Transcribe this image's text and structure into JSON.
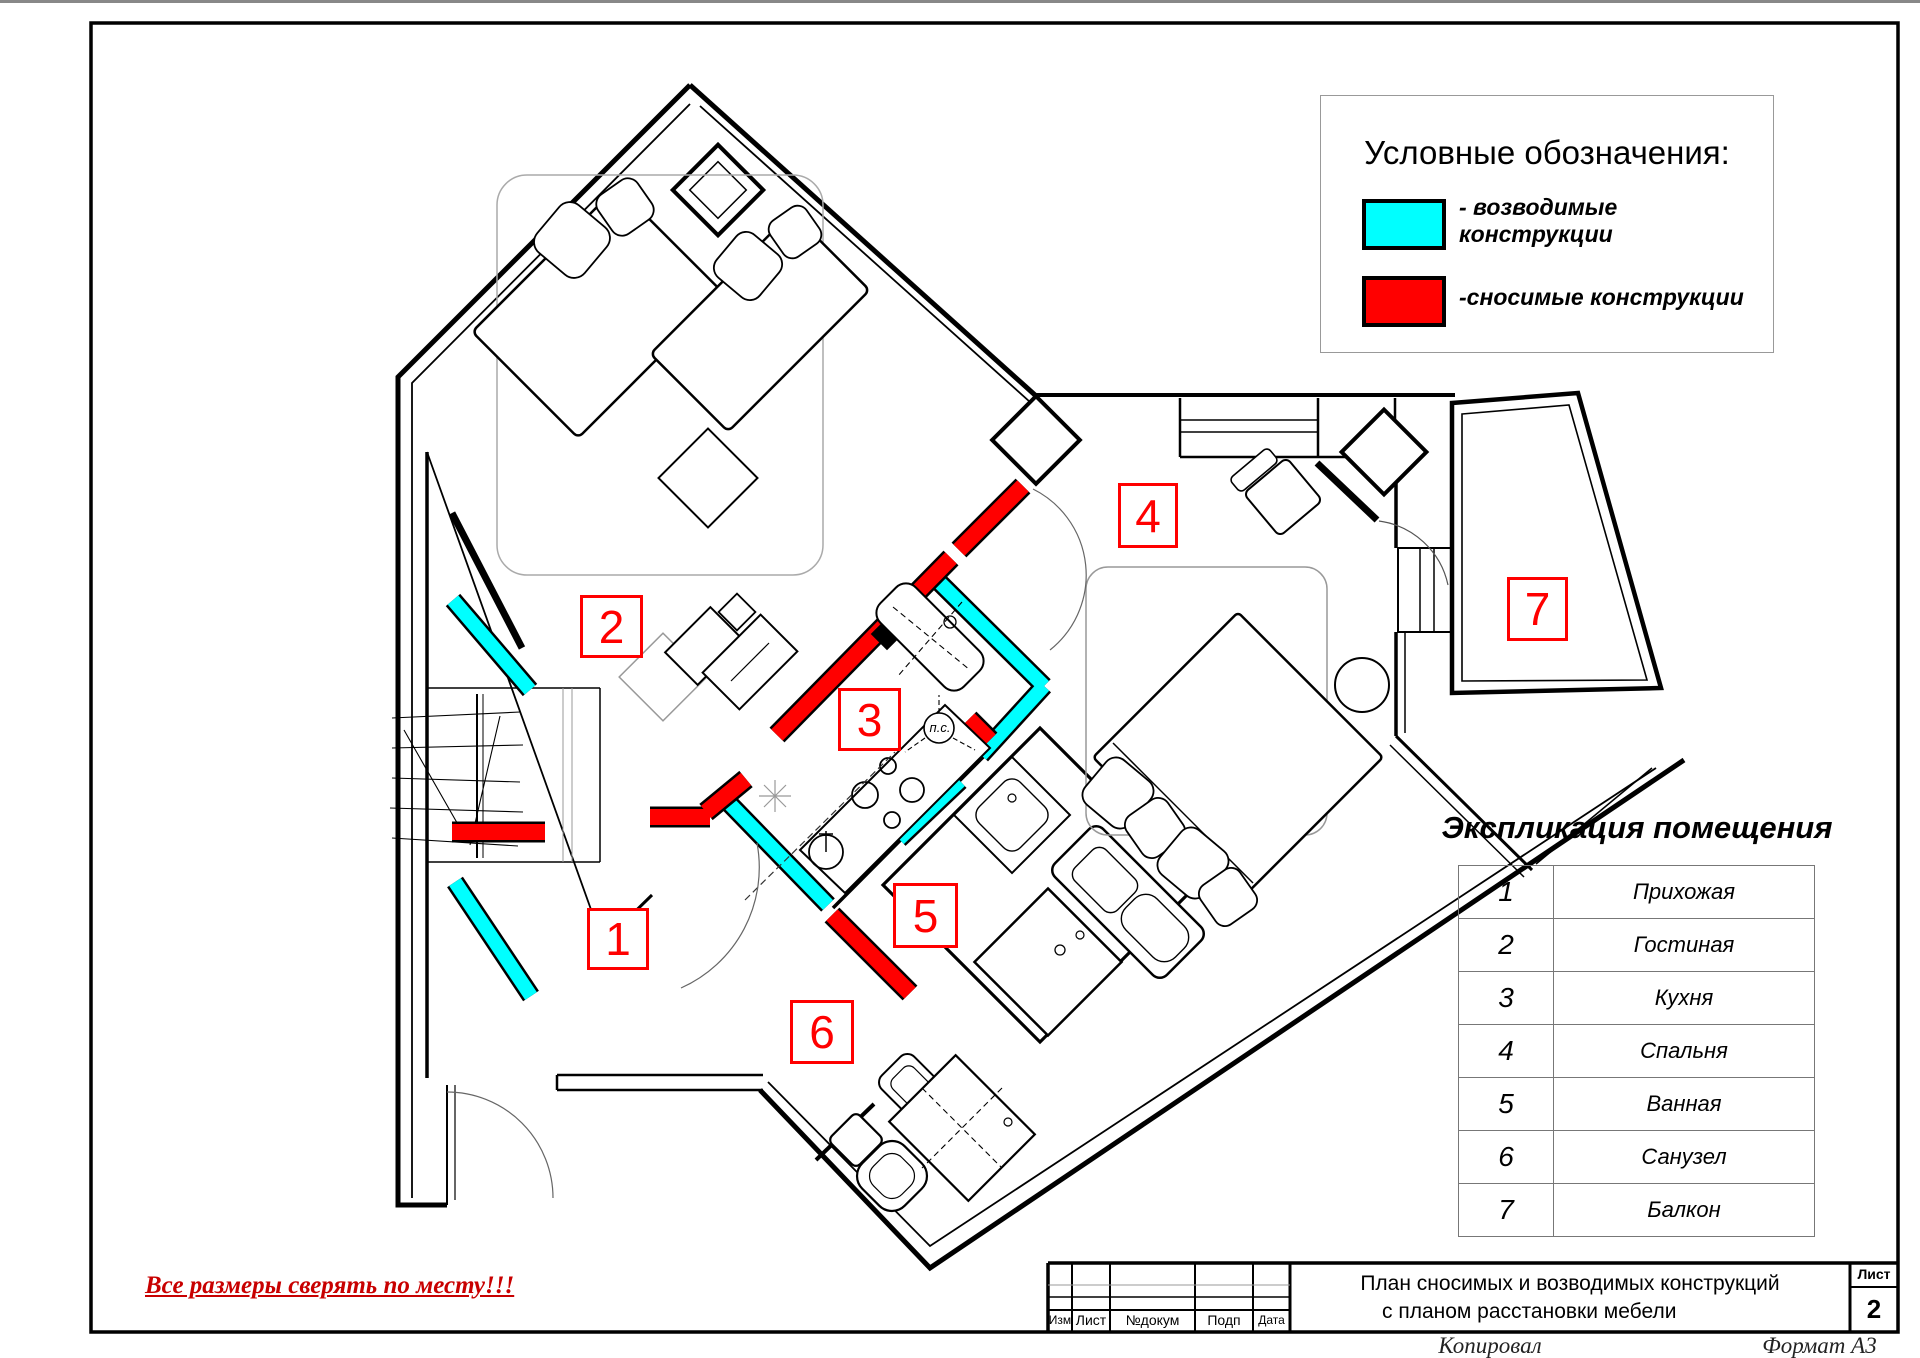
{
  "legend": {
    "title": "Условные обозначения:",
    "items": [
      {
        "color": "#00FFFF",
        "label": "- возводимые конструкции",
        "meaning": "new constructions"
      },
      {
        "color": "#FF0000",
        "label": "-сносимые конструкции",
        "meaning": "demolished constructions"
      }
    ]
  },
  "explication": {
    "title": "Экспликация помещения",
    "rows": [
      {
        "num": "1",
        "name": "Прихожая"
      },
      {
        "num": "2",
        "name": "Гостиная"
      },
      {
        "num": "3",
        "name": "Кухня"
      },
      {
        "num": "4",
        "name": "Спальня"
      },
      {
        "num": "5",
        "name": "Ванная"
      },
      {
        "num": "6",
        "name": "Санузел"
      },
      {
        "num": "7",
        "name": "Балкон"
      }
    ]
  },
  "plan": {
    "room_labels": [
      {
        "num": "1"
      },
      {
        "num": "2"
      },
      {
        "num": "3"
      },
      {
        "num": "4"
      },
      {
        "num": "5"
      },
      {
        "num": "6"
      },
      {
        "num": "7"
      }
    ],
    "ps_label": "п.с.",
    "colors": {
      "new_walls": "#00FFFF",
      "demolished_walls": "#FF0000",
      "walls": "#000000"
    }
  },
  "note": {
    "text": "Все размеры сверять по месту!!!",
    "color": "#C80000"
  },
  "title_block": {
    "doc_title_line1": "План сносимых и возводимых конструкций",
    "doc_title_line2": "с планом расстановки мебели",
    "columns": [
      "Изм",
      "Лист",
      "№докум",
      "Подп",
      "Дата"
    ],
    "sheet_label": "Лист",
    "sheet_number": "2",
    "copied_label": "Копировал",
    "format_label": "Формат  А3"
  }
}
